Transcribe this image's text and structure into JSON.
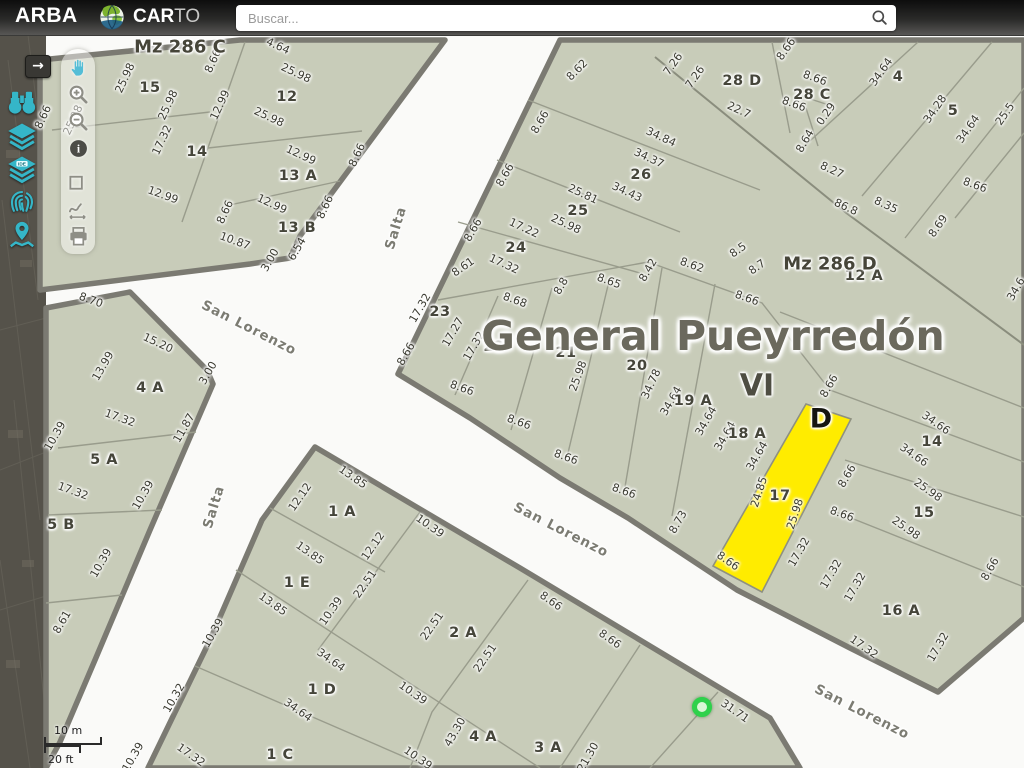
{
  "topbar": {
    "brand": "ARBA",
    "logo_bold": "CAR",
    "logo_light": "TO",
    "search_placeholder": "Buscar...",
    "search_icon": "magnifier-icon"
  },
  "sidebar": {
    "expand_arrow": "→",
    "items": [
      {
        "icon": "binoculars-search"
      },
      {
        "icon": "layers"
      },
      {
        "icon": "layers-ide"
      },
      {
        "icon": "fingerprint"
      },
      {
        "icon": "map-pin-locate"
      }
    ]
  },
  "toolbar": {
    "tools": [
      {
        "icon": "pan-hand"
      },
      {
        "icon": "zoom-in"
      },
      {
        "icon": "zoom-out"
      },
      {
        "icon": "info"
      },
      {
        "icon": "measure-area"
      },
      {
        "icon": "measure-path"
      },
      {
        "icon": "print"
      }
    ]
  },
  "map": {
    "colors": {
      "parcel_fill": "#c8ccb9",
      "street": "#fafaf8",
      "selected_parcel": "#ffec00",
      "marker": "#2ed14b",
      "border": "#7b7a72"
    },
    "title": {
      "t": "General Pueyrredón",
      "x": 713,
      "y": 336
    },
    "region_code": {
      "t": "VI",
      "x": 757,
      "y": 386
    },
    "selected_parcel_letter": {
      "t": "D",
      "x": 821,
      "y": 419
    },
    "selected_parcel_id": "17",
    "block_labels": [
      {
        "t": "Mz 286 C",
        "x": 180,
        "y": 47
      },
      {
        "t": "Mz 286 D",
        "x": 830,
        "y": 264
      }
    ],
    "street_labels": [
      {
        "t": "Salta",
        "x": 396,
        "y": 228,
        "r": -73
      },
      {
        "t": "Salta",
        "x": 214,
        "y": 507,
        "r": -73
      },
      {
        "t": "San Lorenzo",
        "x": 249,
        "y": 328,
        "r": 27
      },
      {
        "t": "San Lorenzo",
        "x": 561,
        "y": 530,
        "r": 27
      },
      {
        "t": "San Lorenzo",
        "x": 862,
        "y": 712,
        "r": 27
      }
    ],
    "parcel_labels": [
      {
        "t": "15",
        "x": 150,
        "y": 88
      },
      {
        "t": "12",
        "x": 287,
        "y": 97
      },
      {
        "t": "14",
        "x": 197,
        "y": 152
      },
      {
        "t": "13 A",
        "x": 298,
        "y": 176
      },
      {
        "t": "13 B",
        "x": 297,
        "y": 228
      },
      {
        "t": "4 A",
        "x": 150,
        "y": 388
      },
      {
        "t": "5 A",
        "x": 104,
        "y": 460
      },
      {
        "t": "5 B",
        "x": 61,
        "y": 525
      },
      {
        "t": "1 A",
        "x": 342,
        "y": 512
      },
      {
        "t": "1 E",
        "x": 297,
        "y": 583
      },
      {
        "t": "2 A",
        "x": 463,
        "y": 633
      },
      {
        "t": "1 D",
        "x": 322,
        "y": 690
      },
      {
        "t": "1 C",
        "x": 280,
        "y": 755
      },
      {
        "t": "4 A",
        "x": 483,
        "y": 737
      },
      {
        "t": "3 A",
        "x": 548,
        "y": 748
      },
      {
        "t": "23",
        "x": 440,
        "y": 312
      },
      {
        "t": "22",
        "x": 494,
        "y": 347
      },
      {
        "t": "21",
        "x": 566,
        "y": 353
      },
      {
        "t": "20",
        "x": 637,
        "y": 366
      },
      {
        "t": "19 A",
        "x": 693,
        "y": 401
      },
      {
        "t": "18 A",
        "x": 747,
        "y": 434
      },
      {
        "t": "17",
        "x": 780,
        "y": 496
      },
      {
        "t": "16 A",
        "x": 901,
        "y": 611
      },
      {
        "t": "15",
        "x": 924,
        "y": 513
      },
      {
        "t": "14",
        "x": 932,
        "y": 442
      },
      {
        "t": "12 A",
        "x": 864,
        "y": 276
      },
      {
        "t": "24",
        "x": 516,
        "y": 248
      },
      {
        "t": "25",
        "x": 578,
        "y": 211
      },
      {
        "t": "26",
        "x": 641,
        "y": 175
      },
      {
        "t": "28 D",
        "x": 742,
        "y": 81
      },
      {
        "t": "28 C",
        "x": 812,
        "y": 95
      },
      {
        "t": "4",
        "x": 898,
        "y": 77
      },
      {
        "t": "5",
        "x": 953,
        "y": 111
      }
    ],
    "dimensions": [
      {
        "t": "25.98",
        "x": 73,
        "y": 120,
        "r": -65
      },
      {
        "t": "25.98",
        "x": 125,
        "y": 78,
        "r": -65
      },
      {
        "t": "25.98",
        "x": 168,
        "y": 105,
        "r": -65
      },
      {
        "t": "8.66",
        "x": 43,
        "y": 117,
        "r": -65
      },
      {
        "t": "8.66",
        "x": 213,
        "y": 61,
        "r": -65
      },
      {
        "t": "17.32",
        "x": 162,
        "y": 140,
        "r": -65
      },
      {
        "t": "12.99",
        "x": 163,
        "y": 195,
        "r": 20
      },
      {
        "t": "4.64",
        "x": 278,
        "y": 46,
        "r": 25
      },
      {
        "t": "25.98",
        "x": 296,
        "y": 73,
        "r": 25
      },
      {
        "t": "12.99",
        "x": 220,
        "y": 105,
        "r": -65
      },
      {
        "t": "25.98",
        "x": 269,
        "y": 117,
        "r": 25
      },
      {
        "t": "8.66",
        "x": 357,
        "y": 155,
        "r": -65
      },
      {
        "t": "12.99",
        "x": 301,
        "y": 155,
        "r": 25
      },
      {
        "t": "12.99",
        "x": 272,
        "y": 204,
        "r": 25
      },
      {
        "t": "8.66",
        "x": 325,
        "y": 207,
        "r": -65
      },
      {
        "t": "8.66",
        "x": 225,
        "y": 212,
        "r": -65
      },
      {
        "t": "10.87",
        "x": 235,
        "y": 241,
        "r": 20
      },
      {
        "t": "3.00",
        "x": 270,
        "y": 260,
        "r": -60
      },
      {
        "t": "6.54",
        "x": 297,
        "y": 249,
        "r": -60
      },
      {
        "t": "8.70",
        "x": 91,
        "y": 300,
        "r": 20
      },
      {
        "t": "13.99",
        "x": 103,
        "y": 366,
        "r": -60
      },
      {
        "t": "15.20",
        "x": 158,
        "y": 343,
        "r": 25
      },
      {
        "t": "3.00",
        "x": 208,
        "y": 373,
        "r": -60
      },
      {
        "t": "11.87",
        "x": 184,
        "y": 428,
        "r": -60
      },
      {
        "t": "17.32",
        "x": 120,
        "y": 418,
        "r": 20
      },
      {
        "t": "10.39",
        "x": 55,
        "y": 436,
        "r": -60
      },
      {
        "t": "17.32",
        "x": 73,
        "y": 491,
        "r": 20
      },
      {
        "t": "10.39",
        "x": 143,
        "y": 495,
        "r": -60
      },
      {
        "t": "10.39",
        "x": 101,
        "y": 563,
        "r": -60
      },
      {
        "t": "8.61",
        "x": 62,
        "y": 622,
        "r": -60
      },
      {
        "t": "13.85",
        "x": 353,
        "y": 477,
        "r": 35
      },
      {
        "t": "12.12",
        "x": 300,
        "y": 497,
        "r": -55
      },
      {
        "t": "12.12",
        "x": 373,
        "y": 546,
        "r": -55
      },
      {
        "t": "10.39",
        "x": 430,
        "y": 526,
        "r": 35
      },
      {
        "t": "13.85",
        "x": 310,
        "y": 553,
        "r": 35
      },
      {
        "t": "22.51",
        "x": 365,
        "y": 584,
        "r": -55
      },
      {
        "t": "10.39",
        "x": 331,
        "y": 611,
        "r": -55
      },
      {
        "t": "13.85",
        "x": 273,
        "y": 604,
        "r": 35
      },
      {
        "t": "22.51",
        "x": 432,
        "y": 626,
        "r": -55
      },
      {
        "t": "22.51",
        "x": 485,
        "y": 658,
        "r": -55
      },
      {
        "t": "34.64",
        "x": 331,
        "y": 660,
        "r": 35
      },
      {
        "t": "10.39",
        "x": 413,
        "y": 693,
        "r": 35
      },
      {
        "t": "43.30",
        "x": 455,
        "y": 732,
        "r": -60
      },
      {
        "t": "34.64",
        "x": 298,
        "y": 710,
        "r": 35
      },
      {
        "t": "10.39",
        "x": 418,
        "y": 758,
        "r": 35
      },
      {
        "t": "21.30",
        "x": 588,
        "y": 757,
        "r": -60
      },
      {
        "t": "17.32",
        "x": 191,
        "y": 755,
        "r": 35
      },
      {
        "t": "10.32",
        "x": 174,
        "y": 698,
        "r": -60
      },
      {
        "t": "10.39",
        "x": 213,
        "y": 633,
        "r": -60
      },
      {
        "t": "10.39",
        "x": 133,
        "y": 757,
        "r": -60
      },
      {
        "t": "8.66",
        "x": 551,
        "y": 601,
        "r": 35
      },
      {
        "t": "8.66",
        "x": 610,
        "y": 639,
        "r": 35
      },
      {
        "t": "31.71",
        "x": 735,
        "y": 711,
        "r": 35
      },
      {
        "t": "17.32",
        "x": 420,
        "y": 308,
        "r": -60
      },
      {
        "t": "17.27",
        "x": 453,
        "y": 332,
        "r": -60
      },
      {
        "t": "8.66",
        "x": 406,
        "y": 354,
        "r": -60
      },
      {
        "t": "8.66",
        "x": 462,
        "y": 388,
        "r": 20
      },
      {
        "t": "17.32",
        "x": 474,
        "y": 346,
        "r": -60
      },
      {
        "t": "8.68",
        "x": 515,
        "y": 300,
        "r": 20
      },
      {
        "t": "8.66",
        "x": 519,
        "y": 422,
        "r": 20
      },
      {
        "t": "25.98",
        "x": 578,
        "y": 376,
        "r": -70
      },
      {
        "t": "8.8",
        "x": 561,
        "y": 286,
        "r": -60
      },
      {
        "t": "8.66",
        "x": 566,
        "y": 457,
        "r": 20
      },
      {
        "t": "34.78",
        "x": 651,
        "y": 384,
        "r": -65
      },
      {
        "t": "8.65",
        "x": 609,
        "y": 281,
        "r": 20
      },
      {
        "t": "8.66",
        "x": 624,
        "y": 491,
        "r": 20
      },
      {
        "t": "34.64",
        "x": 671,
        "y": 401,
        "r": -60
      },
      {
        "t": "34.64",
        "x": 706,
        "y": 421,
        "r": -60
      },
      {
        "t": "8.73",
        "x": 678,
        "y": 522,
        "r": -60
      },
      {
        "t": "34.64",
        "x": 725,
        "y": 436,
        "r": -60
      },
      {
        "t": "34.64",
        "x": 757,
        "y": 456,
        "r": -60
      },
      {
        "t": "8.66",
        "x": 728,
        "y": 561,
        "r": 35
      },
      {
        "t": "24.85",
        "x": 759,
        "y": 492,
        "r": -72
      },
      {
        "t": "25.98",
        "x": 795,
        "y": 514,
        "r": -72
      },
      {
        "t": "8.66",
        "x": 847,
        "y": 476,
        "r": -60
      },
      {
        "t": "8.66",
        "x": 842,
        "y": 514,
        "r": 20
      },
      {
        "t": "17.32",
        "x": 799,
        "y": 552,
        "r": -60
      },
      {
        "t": "17.32",
        "x": 831,
        "y": 574,
        "r": -60
      },
      {
        "t": "17.32",
        "x": 855,
        "y": 587,
        "r": -60
      },
      {
        "t": "17.32",
        "x": 864,
        "y": 647,
        "r": 35
      },
      {
        "t": "17.32",
        "x": 938,
        "y": 647,
        "r": -60
      },
      {
        "t": "8.66",
        "x": 990,
        "y": 569,
        "r": -60
      },
      {
        "t": "25.98",
        "x": 928,
        "y": 490,
        "r": 35
      },
      {
        "t": "25.98",
        "x": 906,
        "y": 528,
        "r": 35
      },
      {
        "t": "34.66",
        "x": 936,
        "y": 423,
        "r": 35
      },
      {
        "t": "34.66",
        "x": 914,
        "y": 455,
        "r": 35
      },
      {
        "t": "8.66",
        "x": 829,
        "y": 386,
        "r": -60
      },
      {
        "t": "34.6",
        "x": 1016,
        "y": 289,
        "r": -60
      },
      {
        "t": "17.22",
        "x": 524,
        "y": 228,
        "r": 25
      },
      {
        "t": "17.32",
        "x": 504,
        "y": 264,
        "r": 25
      },
      {
        "t": "8.66",
        "x": 473,
        "y": 230,
        "r": -60
      },
      {
        "t": "8.61",
        "x": 463,
        "y": 267,
        "r": -35
      },
      {
        "t": "25.81",
        "x": 583,
        "y": 194,
        "r": 25
      },
      {
        "t": "25.98",
        "x": 566,
        "y": 224,
        "r": 25
      },
      {
        "t": "8.66",
        "x": 540,
        "y": 122,
        "r": -60
      },
      {
        "t": "8.66",
        "x": 505,
        "y": 175,
        "r": -60
      },
      {
        "t": "34.84",
        "x": 661,
        "y": 137,
        "r": 25
      },
      {
        "t": "34.37",
        "x": 649,
        "y": 158,
        "r": 25
      },
      {
        "t": "34.43",
        "x": 627,
        "y": 192,
        "r": 25
      },
      {
        "t": "8.62",
        "x": 577,
        "y": 70,
        "r": -45
      },
      {
        "t": "7.26",
        "x": 673,
        "y": 64,
        "r": -55
      },
      {
        "t": "7.26",
        "x": 695,
        "y": 77,
        "r": -55
      },
      {
        "t": "22.7",
        "x": 739,
        "y": 110,
        "r": 25
      },
      {
        "t": "8.66",
        "x": 786,
        "y": 49,
        "r": -55
      },
      {
        "t": "8.66",
        "x": 815,
        "y": 78,
        "r": 20
      },
      {
        "t": "8.66",
        "x": 794,
        "y": 104,
        "r": 20
      },
      {
        "t": "0.29",
        "x": 826,
        "y": 114,
        "r": -55
      },
      {
        "t": "8.64",
        "x": 805,
        "y": 141,
        "r": -60
      },
      {
        "t": "8.27",
        "x": 832,
        "y": 170,
        "r": 25
      },
      {
        "t": "86.8",
        "x": 846,
        "y": 207,
        "r": 25
      },
      {
        "t": "8.35",
        "x": 886,
        "y": 205,
        "r": 25
      },
      {
        "t": "8.5",
        "x": 738,
        "y": 250,
        "r": -35
      },
      {
        "t": "8.7",
        "x": 757,
        "y": 267,
        "r": -35
      },
      {
        "t": "8.62",
        "x": 692,
        "y": 265,
        "r": 20
      },
      {
        "t": "8.42",
        "x": 648,
        "y": 270,
        "r": -60
      },
      {
        "t": "8.66",
        "x": 747,
        "y": 298,
        "r": 20
      },
      {
        "t": "34.64",
        "x": 881,
        "y": 72,
        "r": -55
      },
      {
        "t": "34.28",
        "x": 935,
        "y": 109,
        "r": -55
      },
      {
        "t": "34.64",
        "x": 968,
        "y": 129,
        "r": -55
      },
      {
        "t": "25.5",
        "x": 1005,
        "y": 114,
        "r": -55
      },
      {
        "t": "8.66",
        "x": 975,
        "y": 185,
        "r": 20
      },
      {
        "t": "8.69",
        "x": 938,
        "y": 226,
        "r": -55
      }
    ],
    "marker": {
      "x": 702,
      "y": 707
    },
    "scale": {
      "metric": "10 m",
      "imperial": "20 ft"
    }
  }
}
